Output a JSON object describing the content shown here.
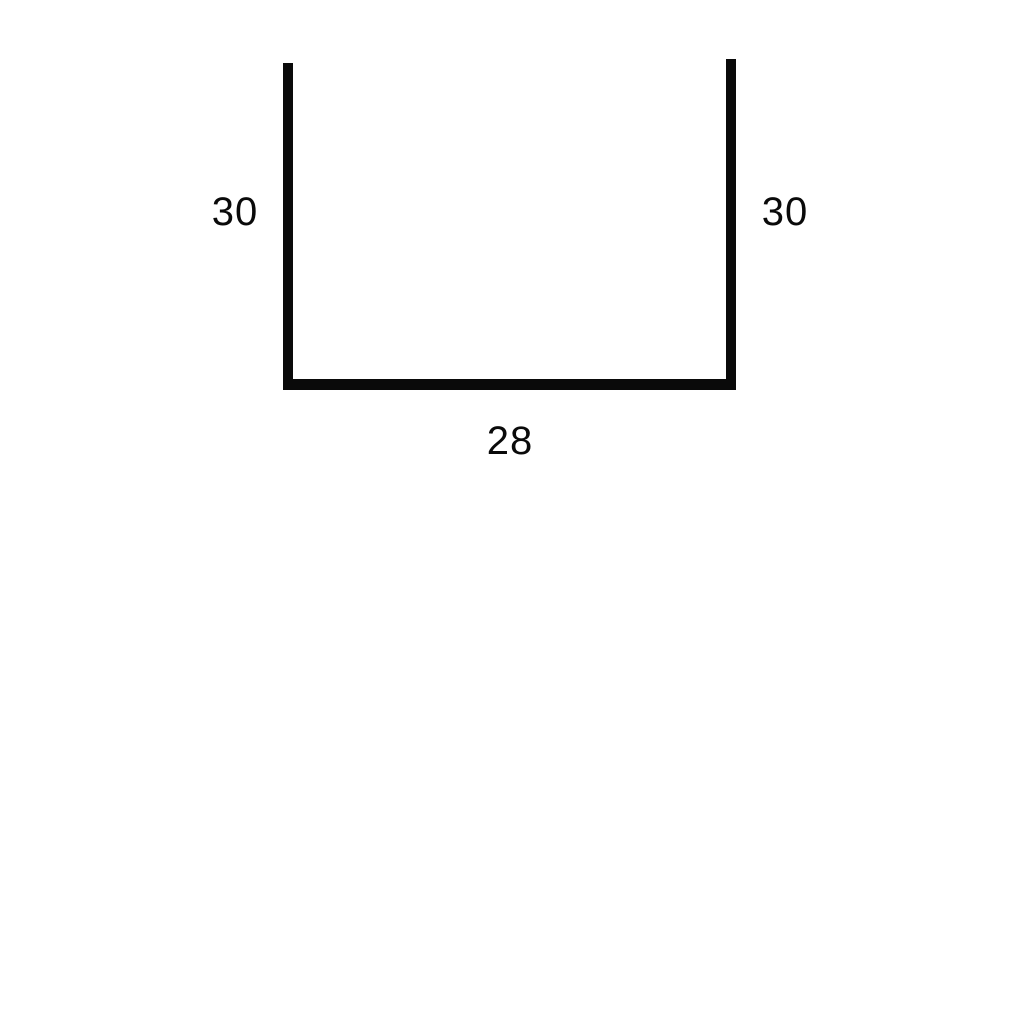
{
  "figure": {
    "description": "U-shape open-top rectangle dimension diagram",
    "background_color": "#ffffff",
    "stroke_color": "#0a0a0a",
    "labels": {
      "left_side": "30",
      "right_side": "30",
      "bottom_side": "28"
    }
  }
}
